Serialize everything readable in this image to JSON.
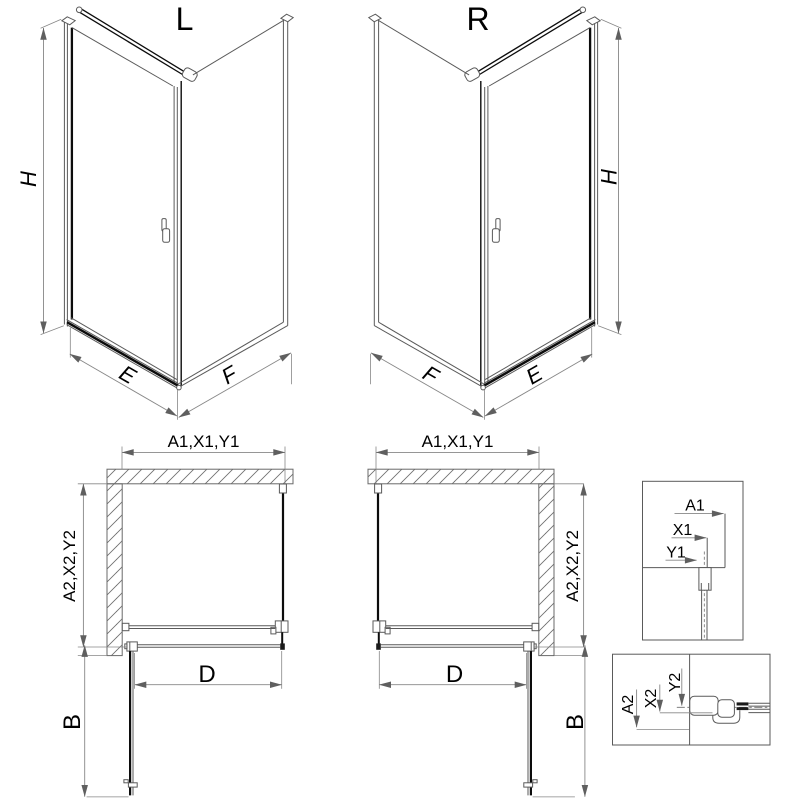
{
  "colors": {
    "line": "#5a5a5a",
    "dark_line": "#0c0c0c",
    "dimension_line": "#878787",
    "hatch": "#707070",
    "text": "#000000",
    "background": "#ffffff"
  },
  "views": {
    "perspective_left": {
      "label": "L",
      "height": "H",
      "door_width": "E",
      "side_width": "F"
    },
    "perspective_right": {
      "label": "R",
      "height": "H",
      "door_width": "E",
      "side_width": "F"
    },
    "plan_left": {
      "width": "A1,X1,Y1",
      "depth": "A2,X2,Y2",
      "opening": "D",
      "door_swing": "B"
    },
    "plan_right": {
      "width": "A1,X1,Y1",
      "depth": "A2,X2,Y2",
      "opening": "D",
      "door_swing": "B"
    },
    "detail_width_profile": {
      "dims": [
        "A1",
        "X1",
        "Y1"
      ]
    },
    "detail_depth_profile": {
      "dims": [
        "A2",
        "X2",
        "Y2"
      ]
    }
  }
}
